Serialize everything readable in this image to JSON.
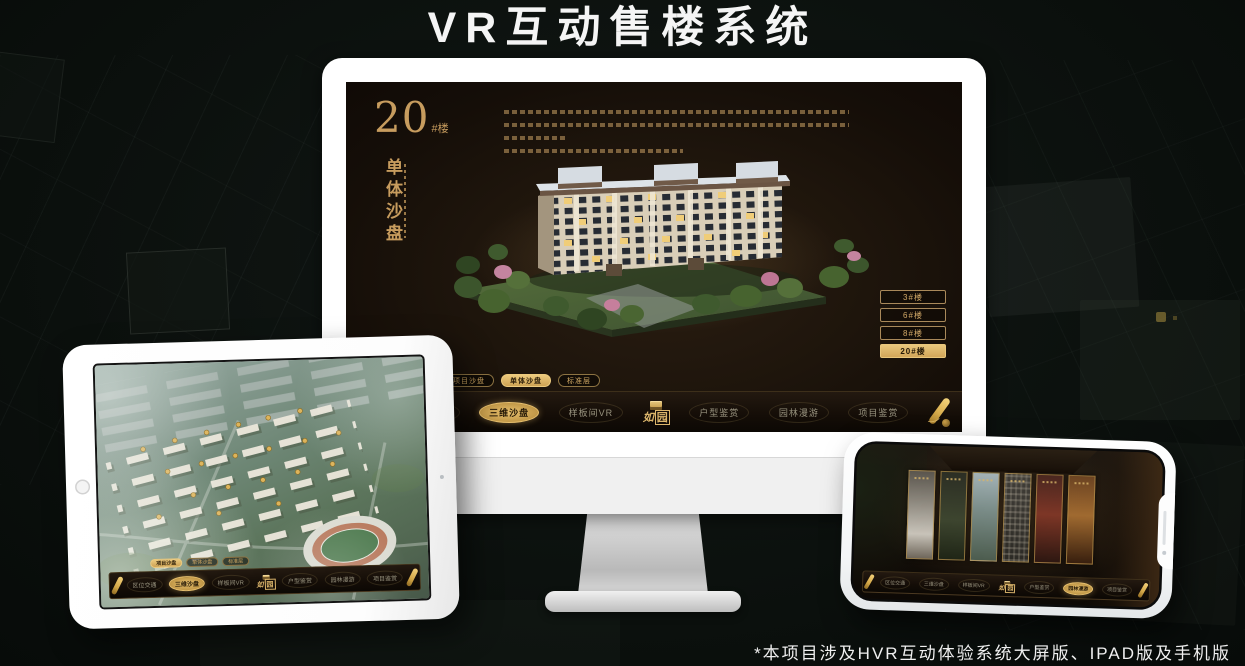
{
  "header": {
    "title": "VR互动售楼系统"
  },
  "footer": {
    "note": "*本项目涉及HVR互动体验系统大屏版、IPAD版及手机版"
  },
  "app": {
    "logo": {
      "first": "如",
      "second": "园"
    },
    "nav_items": [
      "区位交通",
      "三维沙盘",
      "样板间VR",
      "户型鉴赏",
      "园林漫游",
      "项目鉴赏"
    ],
    "sub_tabs": [
      "项目沙盘",
      "单体沙盘",
      "标准层"
    ]
  },
  "monitor": {
    "headline": {
      "number": "20",
      "suffix": "#楼",
      "vertical": "单体沙盘"
    },
    "floor_buttons": [
      {
        "label": "3#楼",
        "selected": false
      },
      {
        "label": "6#楼",
        "selected": false
      },
      {
        "label": "8#楼",
        "selected": false
      },
      {
        "label": "20#楼",
        "selected": true
      }
    ],
    "selected_sub_tab": "单体沙盘",
    "selected_nav": "三维沙盘"
  },
  "tablet": {
    "selected_sub_tab": "项目沙盘",
    "selected_nav": "三维沙盘"
  },
  "phone": {
    "selected_nav": "园林漫游"
  },
  "colors": {
    "gold": "#cda25c",
    "gold_bright": "#e7c276",
    "screen_bg": "#1b130c",
    "page_bg": "#0c110e",
    "title_text": "#f5f5f5"
  }
}
